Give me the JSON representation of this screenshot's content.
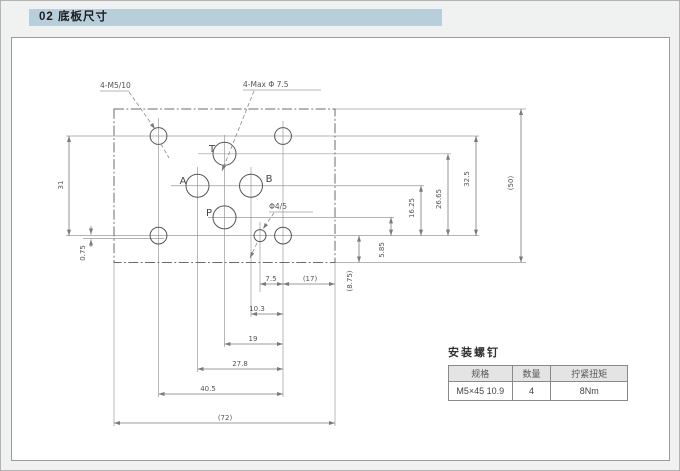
{
  "page": {
    "header_title": "02 底板尺寸"
  },
  "drawing": {
    "callouts": {
      "mounting_holes": "4-M5/10",
      "max_ports": "4-Max Φ 7.5",
      "pin_hole": "Φ4/5"
    },
    "ports": {
      "t": "T",
      "a": "A",
      "b": "B",
      "p": "P"
    },
    "dims": {
      "left_height": "31",
      "left_offset": "0.75",
      "p_height": "5.85",
      "ab_height": "16.25",
      "t_height": "26.65",
      "top_holes_height": "32.5",
      "plate_height": "(50)",
      "bottom_edge": "(8.75)",
      "pin_x": "7.5",
      "edge_x": "(17)",
      "b_x": "10.3",
      "pt_x": "19",
      "a_x": "27.8",
      "holes_x": "40.5",
      "plate_width": "(72)"
    }
  },
  "screw_table": {
    "title": "安装螺钉",
    "headers": [
      "规格",
      "数量",
      "拧紧扭矩"
    ],
    "row": [
      "M5×45 10.9",
      "4",
      "8Nm"
    ]
  }
}
